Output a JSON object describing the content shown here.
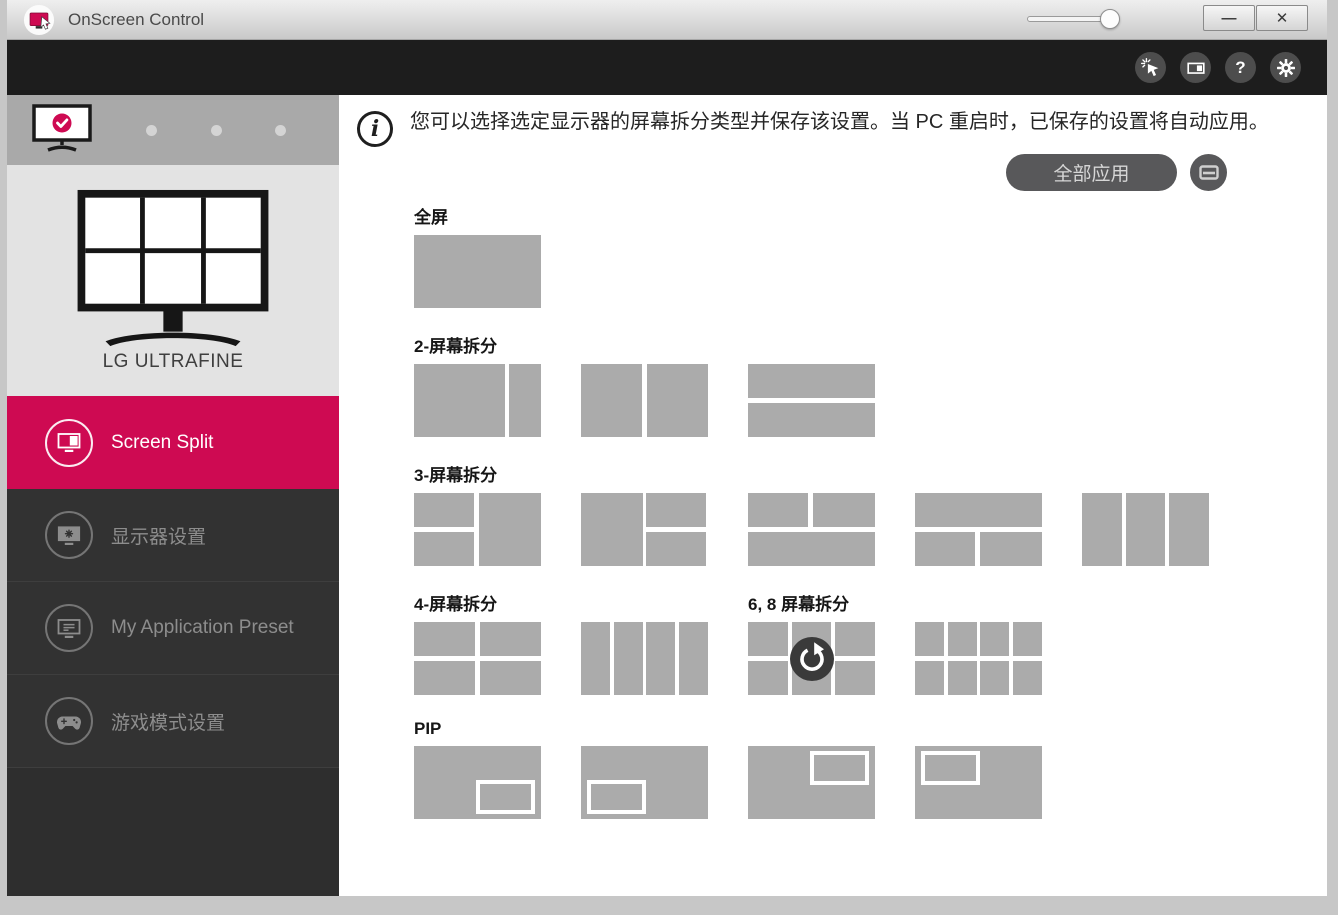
{
  "window": {
    "title": "OnScreen Control",
    "minimize_label": "—",
    "close_label": "✕"
  },
  "toolbar": {
    "icons": [
      {
        "name": "auto-click-icon"
      },
      {
        "name": "split-monitor-icon"
      },
      {
        "name": "help-icon",
        "glyph": "?"
      },
      {
        "name": "settings-gear-icon"
      }
    ]
  },
  "sidebar": {
    "monitor_selector": {
      "selected_index": 0,
      "total_slots": 4
    },
    "monitor_name": "LG ULTRAFINE",
    "menu": [
      {
        "label": "Screen Split",
        "icon": "screen-split-icon",
        "active": true
      },
      {
        "label": "显示器设置",
        "icon": "monitor-settings-icon",
        "active": false
      },
      {
        "label": "My Application Preset",
        "icon": "app-preset-icon",
        "active": false
      },
      {
        "label": "游戏模式设置",
        "icon": "game-icon",
        "active": false
      }
    ]
  },
  "main": {
    "info_text": "您可以选择选定显示器的屏幕拆分类型并保存该设置。当 PC 重启时，已保存的设置将自动应用。",
    "apply_all_label": "全部应用",
    "rows": [
      {
        "sections": [
          {
            "label": "全屏",
            "items": [
              {
                "name": "full-screen",
                "layout": "full"
              }
            ]
          }
        ]
      },
      {
        "sections": [
          {
            "label": "2-屏幕拆分",
            "items": [
              {
                "name": "2-split-left-wide",
                "layout": "v-72-26"
              },
              {
                "name": "2-split-vertical-equal",
                "layout": "v-50-50"
              },
              {
                "name": "2-split-horizontal",
                "layout": "h-50-50"
              }
            ]
          }
        ]
      },
      {
        "sections": [
          {
            "label": "3-屏幕拆分",
            "items": [
              {
                "name": "3-split-left-stacked",
                "layout": "left-stacked"
              },
              {
                "name": "3-split-right-stacked",
                "layout": "right-stacked"
              },
              {
                "name": "3-split-top-two",
                "layout": "top-two"
              },
              {
                "name": "3-split-bottom-two",
                "layout": "bottom-two"
              },
              {
                "name": "3-split-columns",
                "layout": "cols-3"
              }
            ]
          }
        ]
      },
      {
        "sections": [
          {
            "label": "4-屏幕拆分",
            "items": [
              {
                "name": "4-split-grid",
                "layout": "grid-2x2"
              },
              {
                "name": "4-split-columns",
                "layout": "cols-4"
              }
            ]
          },
          {
            "label": "6, 8 屏幕拆分",
            "items": [
              {
                "name": "6-split-grid",
                "layout": "grid-2x3",
                "overlay": "rotate-icon"
              },
              {
                "name": "8-split-grid",
                "layout": "grid-2x4"
              }
            ]
          }
        ]
      },
      {
        "sections": [
          {
            "label": "PIP",
            "items": [
              {
                "name": "pip-bottom-right",
                "layout": "pip",
                "pip": "br"
              },
              {
                "name": "pip-bottom-left",
                "layout": "pip",
                "pip": "bl"
              },
              {
                "name": "pip-top-right",
                "layout": "pip",
                "pip": "tr"
              },
              {
                "name": "pip-top-left",
                "layout": "pip",
                "pip": "tl"
              }
            ]
          }
        ]
      }
    ]
  },
  "colors": {
    "accent_pink": "#ce0a52",
    "toolbar_black": "#1d1d1d",
    "sidebar_dark": "#323232",
    "thumbnail_gray": "#ababab"
  }
}
